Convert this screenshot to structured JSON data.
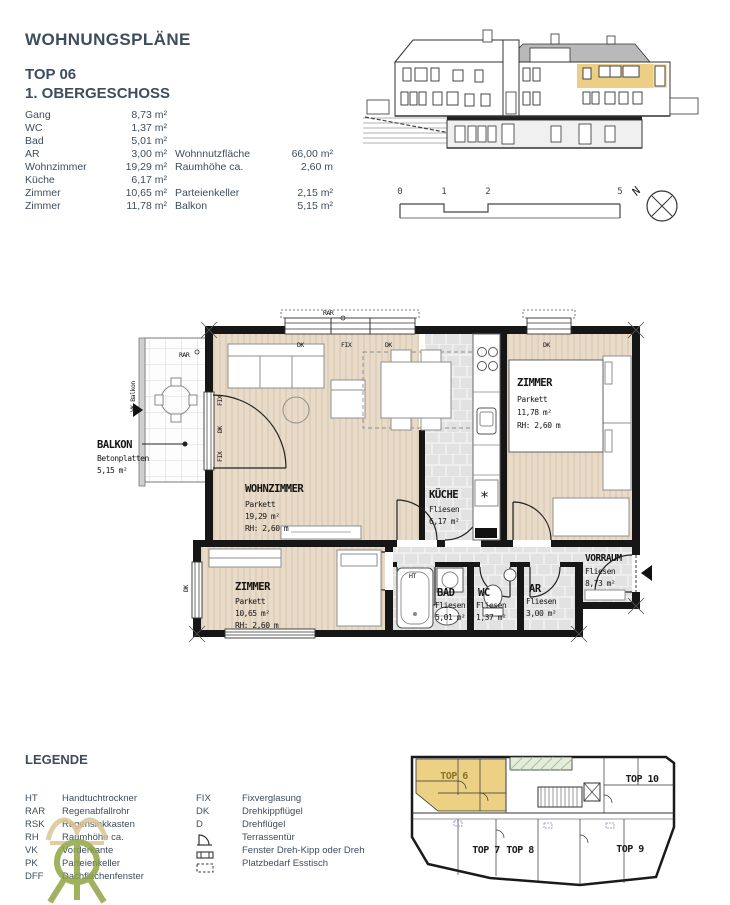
{
  "header": {
    "title": "WOHNUNGSPLÄNE",
    "unit": "TOP 06",
    "floor": "1. OBERGESCHOSS"
  },
  "room_list": [
    {
      "label": "Gang",
      "value": "8,73 m²"
    },
    {
      "label": "WC",
      "value": "1,37 m²"
    },
    {
      "label": "Bad",
      "value": "5,01 m²"
    },
    {
      "label": "AR",
      "value": "3,00 m²"
    },
    {
      "label": "Wohnzimmer",
      "value": "19,29 m²"
    },
    {
      "label": "Küche",
      "value": "6,17 m²"
    },
    {
      "label": "Zimmer",
      "value": "10,65 m²"
    },
    {
      "label": "Zimmer",
      "value": "11,78 m²"
    }
  ],
  "summary": {
    "rows_a": [
      {
        "label": "Wohnnutzfläche",
        "value": "66,00 m²"
      },
      {
        "label": "Raumhöhe ca.",
        "value": "2,60 m"
      }
    ],
    "rows_b": [
      {
        "label": "Parteienkeller",
        "value": "2,15 m²"
      },
      {
        "label": "Balkon",
        "value": "5,15 m²"
      }
    ]
  },
  "scalebar": {
    "ticks": [
      "0",
      "1",
      "2",
      "5"
    ]
  },
  "compass": {
    "label": "N"
  },
  "plan": {
    "rooms": {
      "wohnzimmer": {
        "name": "WOHNZIMMER",
        "floor": "Parkett",
        "area": "19,29 m²",
        "rh": "RH: 2,60 m"
      },
      "kueche": {
        "name": "KÜCHE",
        "floor": "Fliesen",
        "area": "6,17 m²"
      },
      "zimmer1": {
        "name": "ZIMMER",
        "floor": "Parkett",
        "area": "11,78 m²",
        "rh": "RH: 2,60 m"
      },
      "zimmer2": {
        "name": "ZIMMER",
        "floor": "Parkett",
        "area": "10,65 m²",
        "rh": "RH: 2,60 m"
      },
      "bad": {
        "name": "BAD",
        "floor": "Fliesen",
        "area": "5,01 m²"
      },
      "wc": {
        "name": "WC",
        "floor": "Fliesen",
        "area": "1,37 m²"
      },
      "ar": {
        "name": "AR",
        "floor": "Fliesen",
        "area": "3,00 m²"
      },
      "vorraum": {
        "name": "VORRAUM",
        "floor": "Fliesen",
        "area": "8,73 m²"
      },
      "balkon": {
        "name": "BALKON",
        "floor": "Betonplatten",
        "area": "5,15 m²"
      }
    },
    "annotations": {
      "rar": "RAR",
      "fix": "FIX",
      "dk": "DK",
      "vk_balkon": "VK Balkon",
      "ht": "HT"
    }
  },
  "legend": {
    "title": "LEGENDE",
    "left": [
      {
        "abbr": "HT",
        "label": "Handtuchtrockner"
      },
      {
        "abbr": "RAR",
        "label": "Regenabfallrohr"
      },
      {
        "abbr": "RSK",
        "label": "Regensinkkasten"
      },
      {
        "abbr": "RH",
        "label": "Raumhöhe ca."
      },
      {
        "abbr": "VK",
        "label": "Vorderkante"
      },
      {
        "abbr": "PK",
        "label": "Parteienkeller"
      },
      {
        "abbr": "DFF",
        "label": "Dachflächenfenster"
      }
    ],
    "right": [
      {
        "abbr": "FIX",
        "label": "Fixverglasung"
      },
      {
        "abbr": "DK",
        "label": "Drehkippflügel"
      },
      {
        "abbr": "D",
        "label": "Drehflügel"
      },
      {
        "abbr": "",
        "label": "Terrassentür"
      },
      {
        "abbr": "",
        "label": "Fenster Dreh-Kipp oder Dreh"
      },
      {
        "abbr": "",
        "label": "Platzbedarf Esstisch"
      }
    ]
  },
  "siteplan": {
    "units": [
      {
        "label": "TOP 6"
      },
      {
        "label": "TOP 7"
      },
      {
        "label": "TOP 8"
      },
      {
        "label": "TOP 9"
      },
      {
        "label": "TOP 10"
      }
    ]
  },
  "colors": {
    "highlight_yellow": "#ecd185",
    "parquet": "#e8dbc9",
    "tile_gray": "#e4e4e4",
    "text_slate": "#3e4d5c",
    "watermark_green": "#8ca23e",
    "watermark_tan": "#d9c48f"
  }
}
